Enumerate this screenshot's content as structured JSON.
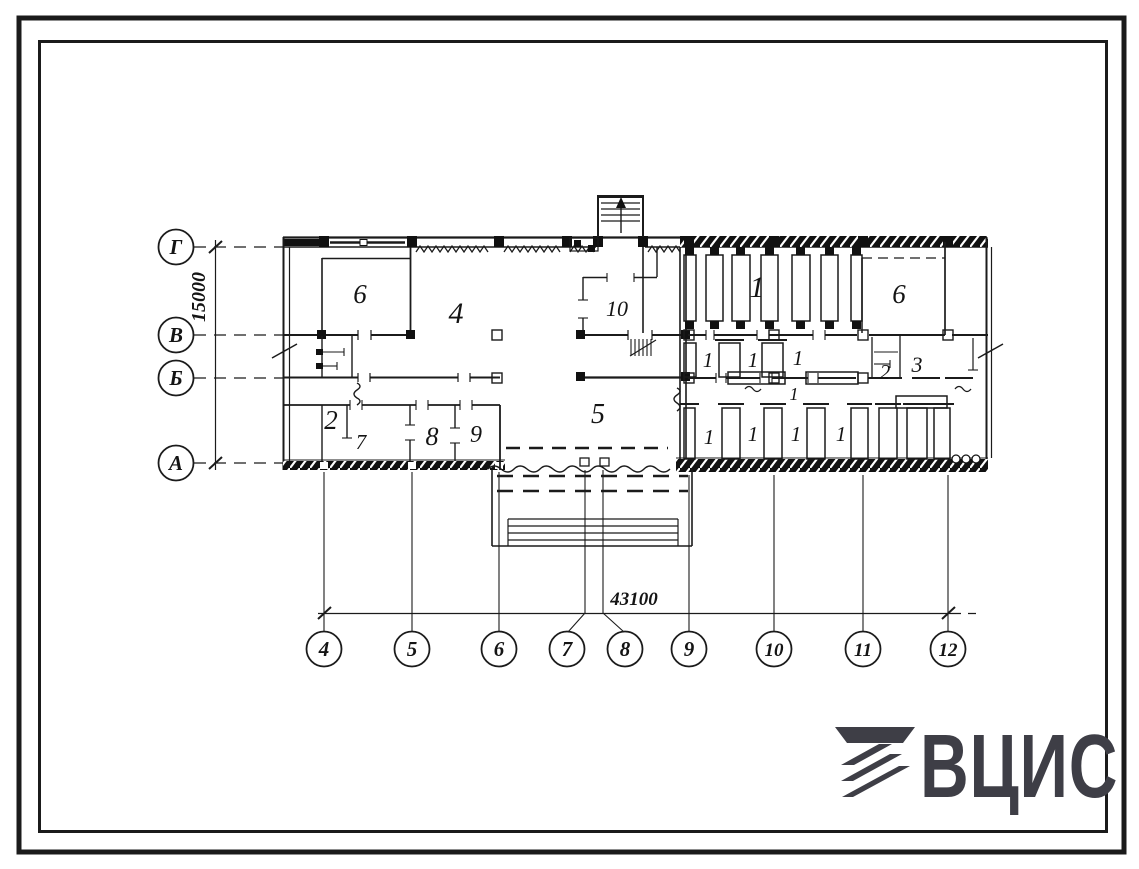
{
  "grid": {
    "row_axes": [
      {
        "label": "Г"
      },
      {
        "label": "В"
      },
      {
        "label": "Б"
      },
      {
        "label": "А"
      }
    ],
    "col_axes": [
      {
        "label": "4"
      },
      {
        "label": "5"
      },
      {
        "label": "6"
      },
      {
        "label": "7"
      },
      {
        "label": "8"
      },
      {
        "label": "9"
      },
      {
        "label": "10"
      },
      {
        "label": "11"
      },
      {
        "label": "12"
      }
    ]
  },
  "dimensions": {
    "vertical": "15000",
    "horizontal": "43100"
  },
  "rooms": {
    "n1": "1",
    "n2": "2",
    "n3": "3",
    "n4": "4",
    "n5": "5",
    "n6": "6",
    "n7": "7",
    "n8": "8",
    "n9": "9",
    "n10": "10"
  },
  "logo": {
    "text": "ВЦИС"
  },
  "colors": {
    "ink": "#1b1b1b",
    "logo": "#3e3e46",
    "paper": "#ffffff"
  }
}
